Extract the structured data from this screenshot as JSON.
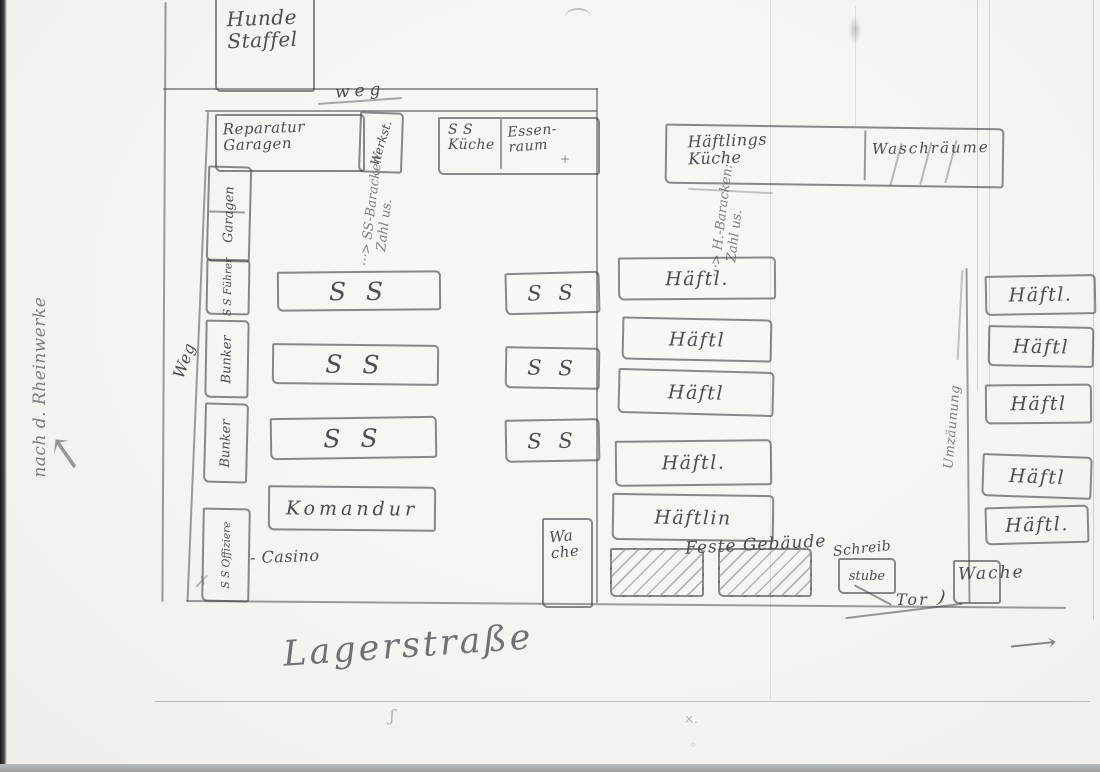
{
  "roads": {
    "weg_top": "weg",
    "weg_left": "Weg",
    "lagerstrasse": "Lagerstraße"
  },
  "outside": {
    "rheinwerke": "nach d. Rheinwerke"
  },
  "kennel": {
    "hunde_staffel": "Hunde\nStaffel"
  },
  "ss_area": {
    "reparatur_garagen": "Reparatur\n     Garagen",
    "werkstatt": "Werkst.",
    "ss_kueche": "S S\nKüche",
    "essen_raum": "Essen-\n    raum",
    "essen_plus": "+",
    "left_column": [
      "Garagen",
      "S S Führer",
      "Bunker",
      "Bunker",
      "S S Offiziere"
    ],
    "casino": "- Casino",
    "annotation_line1": "⋯> SS-Baracken:",
    "annotation_line2": "Zahl us.",
    "blocks": [
      "S S",
      "S S",
      "S S"
    ],
    "komandur": "Komandur",
    "small_blocks": [
      "S S",
      "S S",
      "S S"
    ],
    "wache": "Wa\nche"
  },
  "prisoner_area": {
    "haeftlings_kueche": "Häftlings\n  Küche",
    "waschraeume": "Waschräume",
    "annotation_line1": "⋯> H.-Baracken:",
    "annotation_line2": "Zahl us.",
    "middle_blocks": [
      "Häftl.",
      "Häftl",
      "Häftl",
      "Häftl.",
      "Häftlin"
    ],
    "right_blocks": [
      "Häftl.",
      "Häftl",
      "Häftl",
      "Häftl",
      "Häftl."
    ],
    "feste_gebaeude": "Feste Gebäude",
    "schreib": "Schreib",
    "stube": "stube",
    "tor": "Tor",
    "tor_paren": ")",
    "wache": "Wache",
    "fence": "Umzäunung"
  },
  "symbols": {
    "arrow_right": "⟶",
    "arrow_up_left": "↖"
  }
}
